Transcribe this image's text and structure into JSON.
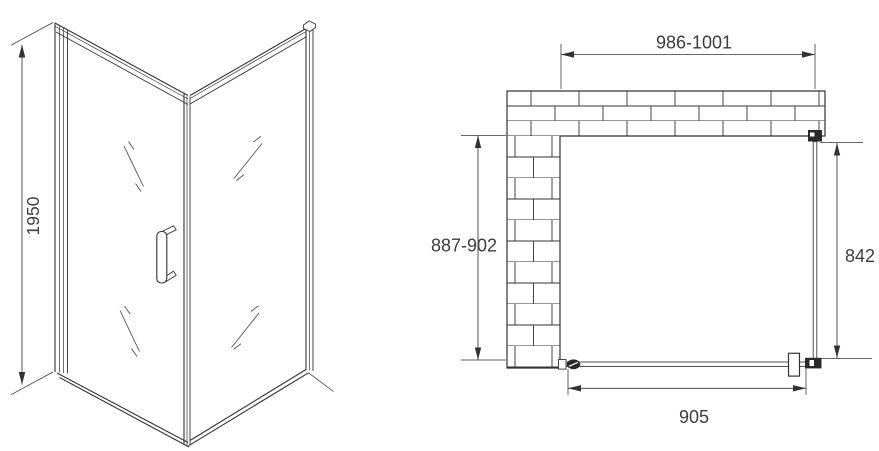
{
  "colors": {
    "line": "#333333",
    "text": "#3d3d3d",
    "fitting": "#2a2a2a",
    "background": "#ffffff"
  },
  "front_view": {
    "height_dimension": "1950"
  },
  "plan_view": {
    "overall_width_dimension": "986-1001",
    "depth_dimension": "887-902",
    "side_panel_dimension": "842",
    "door_width_dimension": "905"
  }
}
